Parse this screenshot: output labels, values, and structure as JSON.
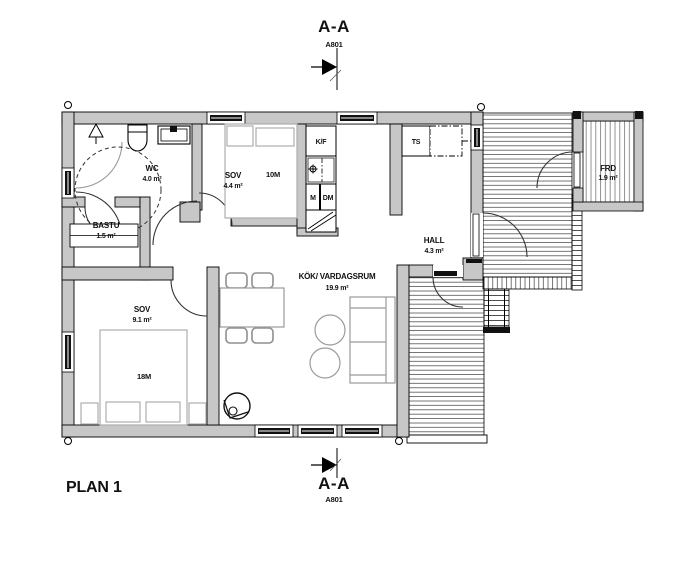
{
  "title": {
    "plan_label": "PLAN 1"
  },
  "section_markers": {
    "top": {
      "label": "A-A",
      "sheet_ref": "A801"
    },
    "bottom": {
      "label": "A-A",
      "sheet_ref": "A801"
    }
  },
  "rooms": {
    "wc": {
      "name": "WC",
      "area": "4.0 m²"
    },
    "bastu": {
      "name": "BASTU",
      "area": "1.5 m²"
    },
    "sov_small": {
      "name": "SOV",
      "area": "4.4 m²"
    },
    "sov_large": {
      "name": "SOV",
      "area": "9.1 m²"
    },
    "hall": {
      "name": "HALL",
      "area": "4.3 m²"
    },
    "kok_vardagsrum": {
      "name": "KÖK/ VARDAGSRUM",
      "area": "19.9 m²"
    },
    "frd": {
      "name": "FRD",
      "area": "1.9 m²"
    }
  },
  "furniture_labels": {
    "bed_small": "10M",
    "bed_large": "18M"
  },
  "appliance_labels": {
    "fridge_freezer": "K/F",
    "washing_machine": "M",
    "dishwasher": "DM",
    "drying_cabinet": "TS"
  },
  "colors": {
    "wall_fill": "#c7c7c7",
    "line": "#000000",
    "furniture_line": "#9a9a9a",
    "deck_line": "#3a3a3a"
  }
}
